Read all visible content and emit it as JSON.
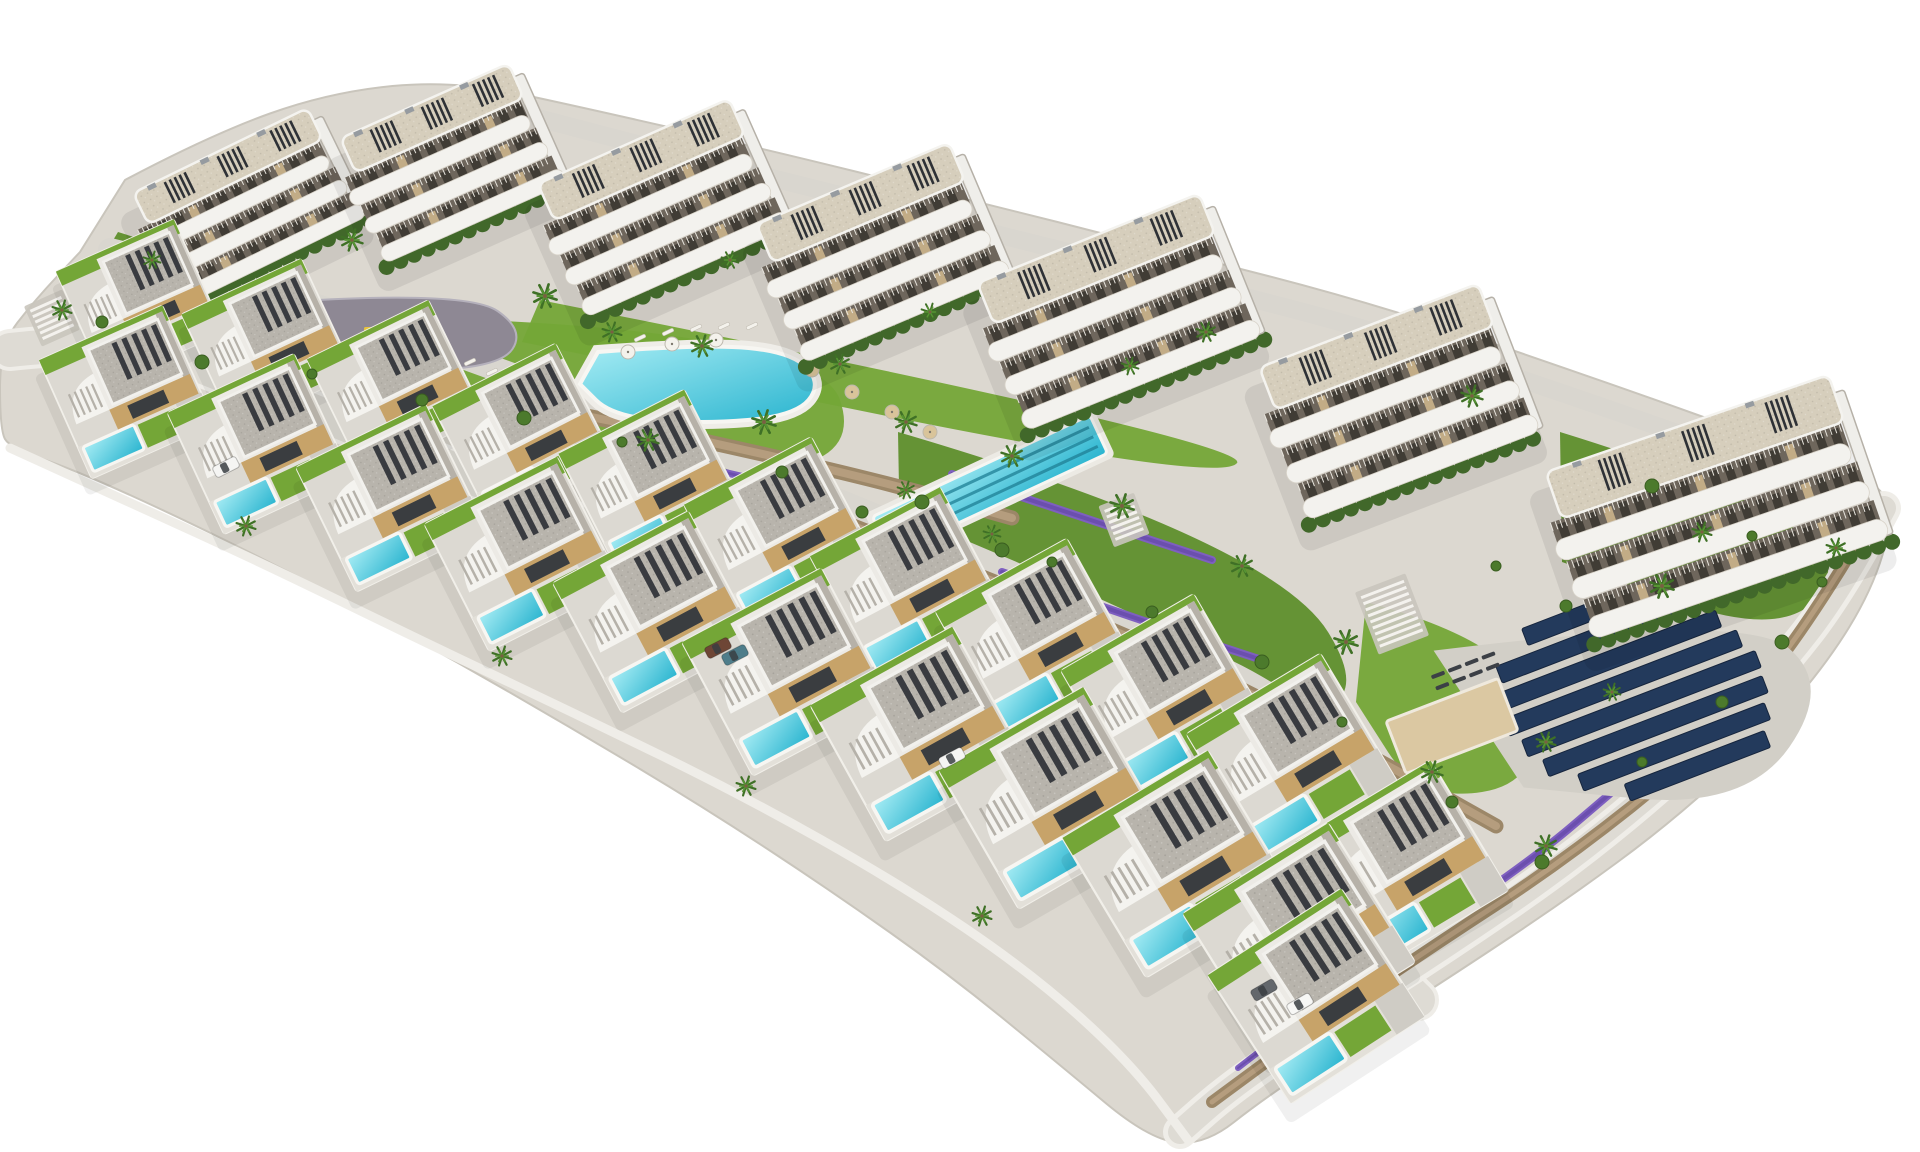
{
  "scene": {
    "kind": "aerial-architectural-render",
    "subject": "residential-resort-development-with-villas-and-apartment-blocks",
    "background": "#ffffff",
    "palette": {
      "land": "#dcd8d0",
      "landEdge": "#c9c5bc",
      "lawn": "#74a637",
      "lawnDark": "#5e8f2c",
      "poolLight": "#a6ecf4",
      "poolDeep": "#29b4cf",
      "laneLine": "#1f7f94",
      "road": "#dedbd4",
      "path": "#d9d6cf",
      "sidewalk": "#efede8",
      "wall": "#9c8768",
      "wallLight": "#b59d7e",
      "plaza": "#8e8894",
      "lavender": "#7e5fc0",
      "solar": "#233a5c",
      "solarEdge": "#16253d",
      "sand": "#dbc8a2",
      "white": "#f3f2ee",
      "roofGray": "#b8b4ac",
      "roofDeck": "#d6cebc",
      "beige": "#c7a369",
      "hedge": "#41682a",
      "bush": "#4c7a2c",
      "palm": "#3f7026",
      "palmLight": "#569433",
      "trunk": "#7a5f43",
      "recess": "#6e665c",
      "window": "#3c3832",
      "pergola": "#2e3136",
      "shade": "#b6b1a8",
      "carBody": "#f6f5f2",
      "umbrellaWhite": "#f4f2ec",
      "umbrellaTan": "#d9c49a"
    },
    "counts": {
      "apartment_blocks": 7,
      "villas_upper_row": 11,
      "villas_lower_row": 11,
      "communal_pools": 2,
      "villa_private_pools": 22,
      "solar_panel_rows": 8,
      "cars": 6
    }
  },
  "land": {
    "outline": [
      [
        125,
        180
      ],
      [
        210,
        135
      ],
      [
        330,
        92
      ],
      [
        455,
        80
      ],
      [
        585,
        108
      ],
      [
        760,
        148
      ],
      [
        955,
        196
      ],
      [
        1160,
        248
      ],
      [
        1380,
        305
      ],
      [
        1600,
        380
      ],
      [
        1790,
        448
      ],
      [
        1880,
        482
      ],
      [
        1893,
        520
      ],
      [
        1872,
        590
      ],
      [
        1826,
        665
      ],
      [
        1756,
        745
      ],
      [
        1668,
        825
      ],
      [
        1566,
        900
      ],
      [
        1458,
        972
      ],
      [
        1352,
        1040
      ],
      [
        1262,
        1100
      ],
      [
        1205,
        1145
      ],
      [
        1150,
        1140
      ],
      [
        1060,
        1065
      ],
      [
        950,
        975
      ],
      [
        830,
        890
      ],
      [
        705,
        808
      ],
      [
        575,
        730
      ],
      [
        445,
        655
      ],
      [
        315,
        585
      ],
      [
        185,
        520
      ],
      [
        75,
        470
      ],
      [
        10,
        448
      ],
      [
        0,
        430
      ],
      [
        0,
        345
      ],
      [
        35,
        300
      ],
      [
        80,
        252
      ]
    ],
    "bottom_wall": [
      [
        10,
        448
      ],
      [
        120,
        498
      ],
      [
        260,
        562
      ],
      [
        420,
        640
      ],
      [
        580,
        716
      ],
      [
        740,
        794
      ],
      [
        900,
        884
      ],
      [
        1030,
        972
      ],
      [
        1130,
        1062
      ],
      [
        1188,
        1140
      ]
    ]
  },
  "lawns": [
    [
      [
        118,
        232
      ],
      [
        330,
        298
      ],
      [
        306,
        362
      ],
      [
        152,
        332
      ],
      [
        88,
        282
      ]
    ],
    [
      [
        428,
        318
      ],
      [
        816,
        330
      ],
      [
        864,
        470
      ],
      [
        624,
        472
      ],
      [
        452,
        394
      ]
    ],
    [
      [
        898,
        432
      ],
      [
        1272,
        542
      ],
      [
        1384,
        722
      ],
      [
        1152,
        702
      ],
      [
        900,
        544
      ]
    ],
    [
      [
        1366,
        602
      ],
      [
        1524,
        644
      ],
      [
        1544,
        782
      ],
      [
        1420,
        802
      ],
      [
        1356,
        702
      ]
    ],
    [
      [
        1560,
        432
      ],
      [
        1852,
        522
      ],
      [
        1800,
        644
      ],
      [
        1562,
        562
      ]
    ],
    [
      [
        540,
        300
      ],
      [
        1252,
        442
      ],
      [
        1222,
        484
      ],
      [
        522,
        342
      ]
    ]
  ],
  "roads": {
    "top": {
      "pts": [
        [
          470,
          100
        ],
        [
          620,
          140
        ],
        [
          800,
          185
        ],
        [
          1000,
          235
        ],
        [
          1200,
          285
        ],
        [
          1380,
          332
        ],
        [
          1560,
          392
        ],
        [
          1720,
          448
        ]
      ],
      "w": 18
    },
    "upper": {
      "pts": [
        [
          110,
          250
        ],
        [
          268,
          289
        ],
        [
          396,
          333
        ],
        [
          524,
          379
        ],
        [
          652,
          427
        ],
        [
          780,
          477
        ],
        [
          908,
          529
        ],
        [
          1036,
          583
        ],
        [
          1164,
          641
        ],
        [
          1292,
          703
        ],
        [
          1402,
          811
        ]
      ],
      "w": 24
    },
    "lower": {
      "pts": [
        [
          10,
          350
        ],
        [
          127,
          337
        ],
        [
          259,
          389
        ],
        [
          391,
          443
        ],
        [
          523,
          499
        ],
        [
          655,
          557
        ],
        [
          787,
          617
        ],
        [
          919,
          679
        ],
        [
          1051,
          743
        ],
        [
          1177,
          809
        ],
        [
          1299,
          883
        ],
        [
          1418,
          1000
        ]
      ],
      "w": 34
    },
    "perimeter": {
      "pts": [
        [
          1884,
          508
        ],
        [
          1842,
          588
        ],
        [
          1772,
          678
        ],
        [
          1682,
          768
        ],
        [
          1566,
          864
        ],
        [
          1440,
          950
        ],
        [
          1318,
          1028
        ],
        [
          1230,
          1088
        ],
        [
          1180,
          1132
        ]
      ],
      "w": 24
    }
  },
  "walls": [
    {
      "pts": [
        [
          128,
          296
        ],
        [
          262,
          332
        ],
        [
          366,
          364
        ]
      ],
      "w": 13
    },
    {
      "pts": [
        [
          330,
          374
        ],
        [
          520,
          402
        ],
        [
          702,
          440
        ],
        [
          884,
          482
        ],
        [
          1012,
          518
        ]
      ],
      "w": 15
    },
    {
      "pts": [
        [
          848,
          524
        ],
        [
          1022,
          592
        ],
        [
          1202,
          668
        ],
        [
          1382,
          762
        ],
        [
          1496,
          826
        ]
      ],
      "w": 15
    },
    {
      "pts": [
        [
          1868,
          524
        ],
        [
          1800,
          640
        ],
        [
          1700,
          752
        ],
        [
          1562,
          862
        ],
        [
          1424,
          952
        ],
        [
          1296,
          1040
        ],
        [
          1212,
          1102
        ]
      ],
      "w": 12
    }
  ],
  "lavender": [
    {
      "pts": [
        [
          300,
          372
        ],
        [
          420,
          398
        ],
        [
          540,
          420
        ]
      ],
      "w": 7
    },
    {
      "pts": [
        [
          560,
          436
        ],
        [
          700,
          466
        ],
        [
          830,
          498
        ]
      ],
      "w": 7
    },
    {
      "pts": [
        [
          952,
          474
        ],
        [
          1090,
          520
        ],
        [
          1212,
          560
        ]
      ],
      "w": 8
    },
    {
      "pts": [
        [
          1002,
          572
        ],
        [
          1140,
          620
        ],
        [
          1262,
          660
        ]
      ],
      "w": 8
    },
    {
      "pts": [
        [
          1064,
          672
        ],
        [
          1200,
          720
        ],
        [
          1312,
          748
        ]
      ],
      "w": 8
    },
    {
      "pts": [
        [
          1430,
          930
        ],
        [
          1530,
          862
        ],
        [
          1612,
          792
        ]
      ],
      "w": 8
    },
    {
      "pts": [
        [
          1238,
          1068
        ],
        [
          1318,
          1006
        ]
      ],
      "w": 6
    },
    {
      "pts": [
        [
          92,
          304
        ],
        [
          148,
          338
        ]
      ],
      "w": 6
    }
  ],
  "plaza": {
    "outline": [
      [
        318,
        300
      ],
      [
        470,
        292
      ],
      [
        525,
        330
      ],
      [
        500,
        368
      ],
      [
        360,
        372
      ],
      [
        300,
        340
      ]
    ],
    "equipment": [
      [
        368,
        330,
        "#e6c23c"
      ],
      [
        398,
        344,
        "#cc5a48"
      ],
      [
        428,
        331,
        "#4c86c9"
      ],
      [
        385,
        352,
        "#e6e3dd"
      ]
    ]
  },
  "pool_freeform": {
    "outline": [
      [
        598,
        352
      ],
      [
        705,
        344
      ],
      [
        792,
        352
      ],
      [
        822,
        384
      ],
      [
        795,
        416
      ],
      [
        700,
        424
      ],
      [
        612,
        416
      ],
      [
        580,
        384
      ]
    ],
    "loungers": [
      [
        470,
        362
      ],
      [
        492,
        372
      ],
      [
        514,
        382
      ],
      [
        536,
        392
      ],
      [
        558,
        402
      ],
      [
        480,
        396
      ],
      [
        502,
        406
      ],
      [
        524,
        416
      ],
      [
        546,
        426
      ],
      [
        640,
        338
      ],
      [
        668,
        332
      ],
      [
        696,
        328
      ],
      [
        724,
        326
      ],
      [
        752,
        326
      ]
    ],
    "umbrellas": [
      [
        628,
        352,
        "w"
      ],
      [
        672,
        344,
        "w"
      ],
      [
        716,
        340,
        "w"
      ],
      [
        812,
        370,
        "t"
      ],
      [
        852,
        392,
        "t"
      ],
      [
        892,
        412,
        "t"
      ],
      [
        930,
        432,
        "t"
      ]
    ]
  },
  "pool_lap": {
    "cx": 990,
    "cy": 485,
    "w": 240,
    "h": 42,
    "rot": -25,
    "lanes": 3
  },
  "solar": {
    "cx": 1640,
    "cy": 700,
    "rot": -21,
    "pad": [
      [
        -175,
        -120
      ],
      [
        130,
        -45
      ],
      [
        185,
        55
      ],
      [
        60,
        140
      ],
      [
        -140,
        40
      ]
    ],
    "bars": [
      [
        -100,
        150,
        -10
      ],
      [
        -74,
        205,
        -20
      ],
      [
        -48,
        235,
        -15
      ],
      [
        -22,
        250,
        -10
      ],
      [
        4,
        250,
        0
      ],
      [
        30,
        235,
        5
      ],
      [
        56,
        200,
        15
      ],
      [
        82,
        150,
        30
      ]
    ]
  },
  "petanque": {
    "cx": 1452,
    "cy": 726,
    "rot": -21,
    "w": 120,
    "h": 56
  },
  "lounger_deck": {
    "cx": 1468,
    "cy": 672,
    "rot": -21,
    "rows": 2,
    "cols": 4
  },
  "stairs": [
    {
      "cx": 1392,
      "cy": 614,
      "rot": -21,
      "n": 9,
      "len": 46,
      "gap": 6.5
    },
    {
      "cx": 1124,
      "cy": 520,
      "rot": -21,
      "n": 6,
      "len": 30,
      "gap": 6
    },
    {
      "cx": 52,
      "cy": 318,
      "rot": -24,
      "n": 6,
      "len": 34,
      "gap": 6
    }
  ],
  "blocks": [
    {
      "id": "A",
      "cx": 248,
      "cy": 212,
      "w": 210,
      "h": 135,
      "rot": -26
    },
    {
      "id": "B",
      "cx": 452,
      "cy": 168,
      "w": 200,
      "h": 145,
      "rot": -24
    },
    {
      "id": "C",
      "cx": 663,
      "cy": 213,
      "w": 225,
      "h": 155,
      "rot": -24
    },
    {
      "id": "D",
      "cx": 882,
      "cy": 258,
      "w": 225,
      "h": 160,
      "rot": -23
    },
    {
      "id": "E",
      "cx": 1118,
      "cy": 318,
      "w": 255,
      "h": 170,
      "rot": -22
    },
    {
      "id": "F",
      "cx": 1398,
      "cy": 408,
      "w": 250,
      "h": 175,
      "rot": -21
    },
    {
      "id": "G",
      "cx": 1716,
      "cy": 514,
      "w": 315,
      "h": 190,
      "rot": -19
    }
  ],
  "villas_upper": [
    [
      140,
      302,
      -24,
      0.86
    ],
    [
      268,
      344,
      -25,
      0.88
    ],
    [
      396,
      388,
      -26,
      0.9
    ],
    [
      524,
      434,
      -27,
      0.92
    ],
    [
      652,
      482,
      -27,
      0.94
    ],
    [
      780,
      532,
      -28,
      0.96
    ],
    [
      908,
      584,
      -28,
      0.98
    ],
    [
      1036,
      638,
      -29,
      1.0
    ],
    [
      1164,
      696,
      -30,
      1.02
    ],
    [
      1292,
      758,
      -31,
      1.04
    ],
    [
      1402,
      866,
      -31,
      1.05
    ]
  ],
  "villas_lower": [
    [
      127,
      392,
      -24,
      0.9
    ],
    [
      259,
      444,
      -25,
      0.93
    ],
    [
      391,
      498,
      -26,
      0.96
    ],
    [
      523,
      554,
      -27,
      0.99
    ],
    [
      655,
      612,
      -28,
      1.02
    ],
    [
      787,
      672,
      -28,
      1.05
    ],
    [
      919,
      734,
      -29,
      1.08
    ],
    [
      1051,
      798,
      -30,
      1.11
    ],
    [
      1177,
      864,
      -31,
      1.13
    ],
    [
      1299,
      938,
      -32,
      1.14
    ],
    [
      1316,
      996,
      -33,
      1.06
    ]
  ],
  "palms": [
    [
      352,
      240,
      1.0
    ],
    [
      545,
      296,
      1.1
    ],
    [
      612,
      332,
      0.9
    ],
    [
      702,
      346,
      1.0
    ],
    [
      764,
      422,
      1.1
    ],
    [
      648,
      440,
      1.0
    ],
    [
      840,
      364,
      0.9
    ],
    [
      906,
      422,
      1.0
    ],
    [
      1012,
      456,
      1.0
    ],
    [
      1122,
      506,
      1.1
    ],
    [
      1206,
      332,
      0.9
    ],
    [
      1242,
      566,
      1.0
    ],
    [
      1346,
      642,
      1.1
    ],
    [
      1432,
      772,
      1.0
    ],
    [
      1546,
      846,
      1.0
    ],
    [
      1662,
      586,
      1.1
    ],
    [
      1702,
      532,
      0.9
    ],
    [
      1472,
      396,
      1.0
    ],
    [
      62,
      310,
      0.9
    ],
    [
      152,
      260,
      0.8
    ],
    [
      906,
      490,
      0.8
    ],
    [
      992,
      534,
      0.8
    ],
    [
      246,
      526,
      0.9
    ],
    [
      502,
      656,
      0.9
    ],
    [
      746,
      786,
      0.9
    ],
    [
      982,
      916,
      0.9
    ],
    [
      1546,
      742,
      0.9
    ],
    [
      1612,
      692,
      0.8
    ],
    [
      1836,
      548,
      0.9
    ],
    [
      730,
      260,
      0.8
    ],
    [
      930,
      312,
      0.8
    ],
    [
      1130,
      366,
      0.8
    ]
  ],
  "bushes": [
    [
      312,
      374
    ],
    [
      422,
      400
    ],
    [
      524,
      418
    ],
    [
      622,
      442
    ],
    [
      782,
      472
    ],
    [
      922,
      502
    ],
    [
      1052,
      562
    ],
    [
      1152,
      612
    ],
    [
      1262,
      662
    ],
    [
      1342,
      722
    ],
    [
      1452,
      802
    ],
    [
      1542,
      862
    ],
    [
      1642,
      762
    ],
    [
      1722,
      702
    ],
    [
      1782,
      642
    ],
    [
      1822,
      582
    ],
    [
      102,
      322
    ],
    [
      202,
      362
    ],
    [
      1496,
      566
    ],
    [
      1566,
      606
    ],
    [
      1652,
      486
    ],
    [
      1752,
      536
    ],
    [
      862,
      512
    ],
    [
      1002,
      550
    ]
  ],
  "cars": [
    {
      "x": 226,
      "y": 467,
      "rot": -27,
      "color": "#f5f5f3"
    },
    {
      "x": 718,
      "y": 648,
      "rot": -27,
      "color": "#6e4636"
    },
    {
      "x": 735,
      "y": 655,
      "rot": -27,
      "color": "#4e7d8a"
    },
    {
      "x": 952,
      "y": 758,
      "rot": -28,
      "color": "#f5f5f3"
    },
    {
      "x": 1264,
      "y": 990,
      "rot": -30,
      "color": "#63676c"
    },
    {
      "x": 1300,
      "y": 1004,
      "rot": -30,
      "color": "#f7f7f5"
    }
  ]
}
